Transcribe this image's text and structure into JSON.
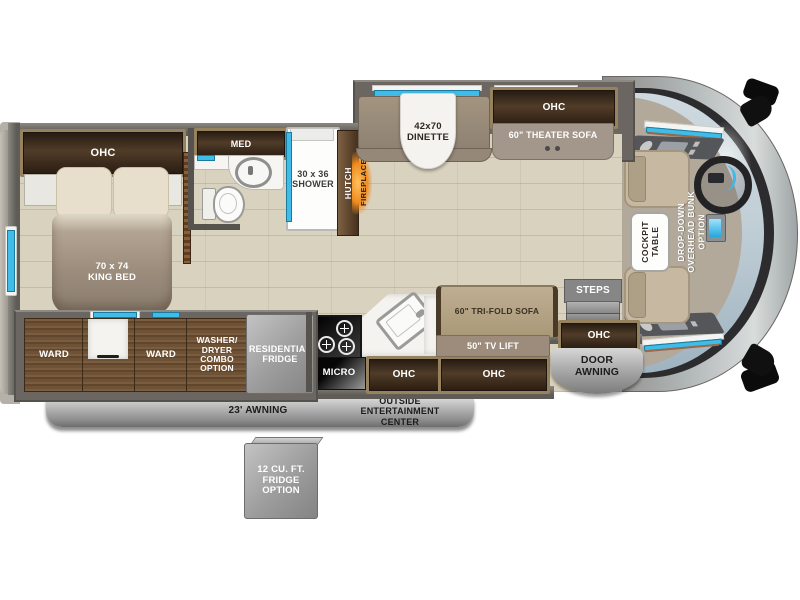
{
  "floorplan_title": "Class A motorhome floor plan",
  "labels": {
    "bedroom_ohc": "OHC",
    "king_bed": "70 x 74\nKING BED",
    "med": "MED",
    "shower": "30 x 36\nSHOWER",
    "hutch": "HUTCH",
    "fireplace": "FIREPLACE",
    "dinette": "42x70\nDINETTE",
    "theater_ohc": "OHC",
    "theater_sofa": "60\" THEATER SOFA",
    "cockpit_table": "COCKPIT\nTABLE",
    "overhead_bunk": "DROP-DOWN\nOVERHEAD BUNK\nOPTION",
    "steps": "STEPS",
    "entry_ohc": "OHC",
    "door_awning": "DOOR\nAWNING",
    "ward_left": "WARD",
    "ward_right": "WARD",
    "washer_dryer": "WASHER/\nDRYER\nCOMBO\nOPTION",
    "residential_fridge": "RESIDENTIAL\nFRIDGE",
    "micro": "MICRO",
    "kitchen_ohc_left": "OHC",
    "kitchen_ohc_right": "OHC",
    "tri_fold_sofa": "60\" TRI-FOLD SOFA",
    "tv_lift": "50\" TV LIFT",
    "outside_entertainment": "OUTSIDE\nENTERTAINMENT\nCENTER",
    "awning": "23' AWNING",
    "fridge_option": "12 CU. FT.\nFRIDGE\nOPTION"
  },
  "colors": {
    "floor_tile": "#d9d2bf",
    "wall_gray": "#6b6661",
    "cabinet_wood_dark": "#3a2b1d",
    "cabinet_frame": "#97825f",
    "ward_wood": "#6b513a",
    "upholstery_taupe": "#9d9082",
    "sofa_tan": "#b5a48c",
    "marble_white": "#f4f3f0",
    "exterior_gray": "#a9a9a9",
    "window_cyan": "#3fbde8",
    "accent_copper": "#9b6848",
    "fireplace_orange": "#e8821f",
    "windshield_blue": "#c4d1d9"
  }
}
